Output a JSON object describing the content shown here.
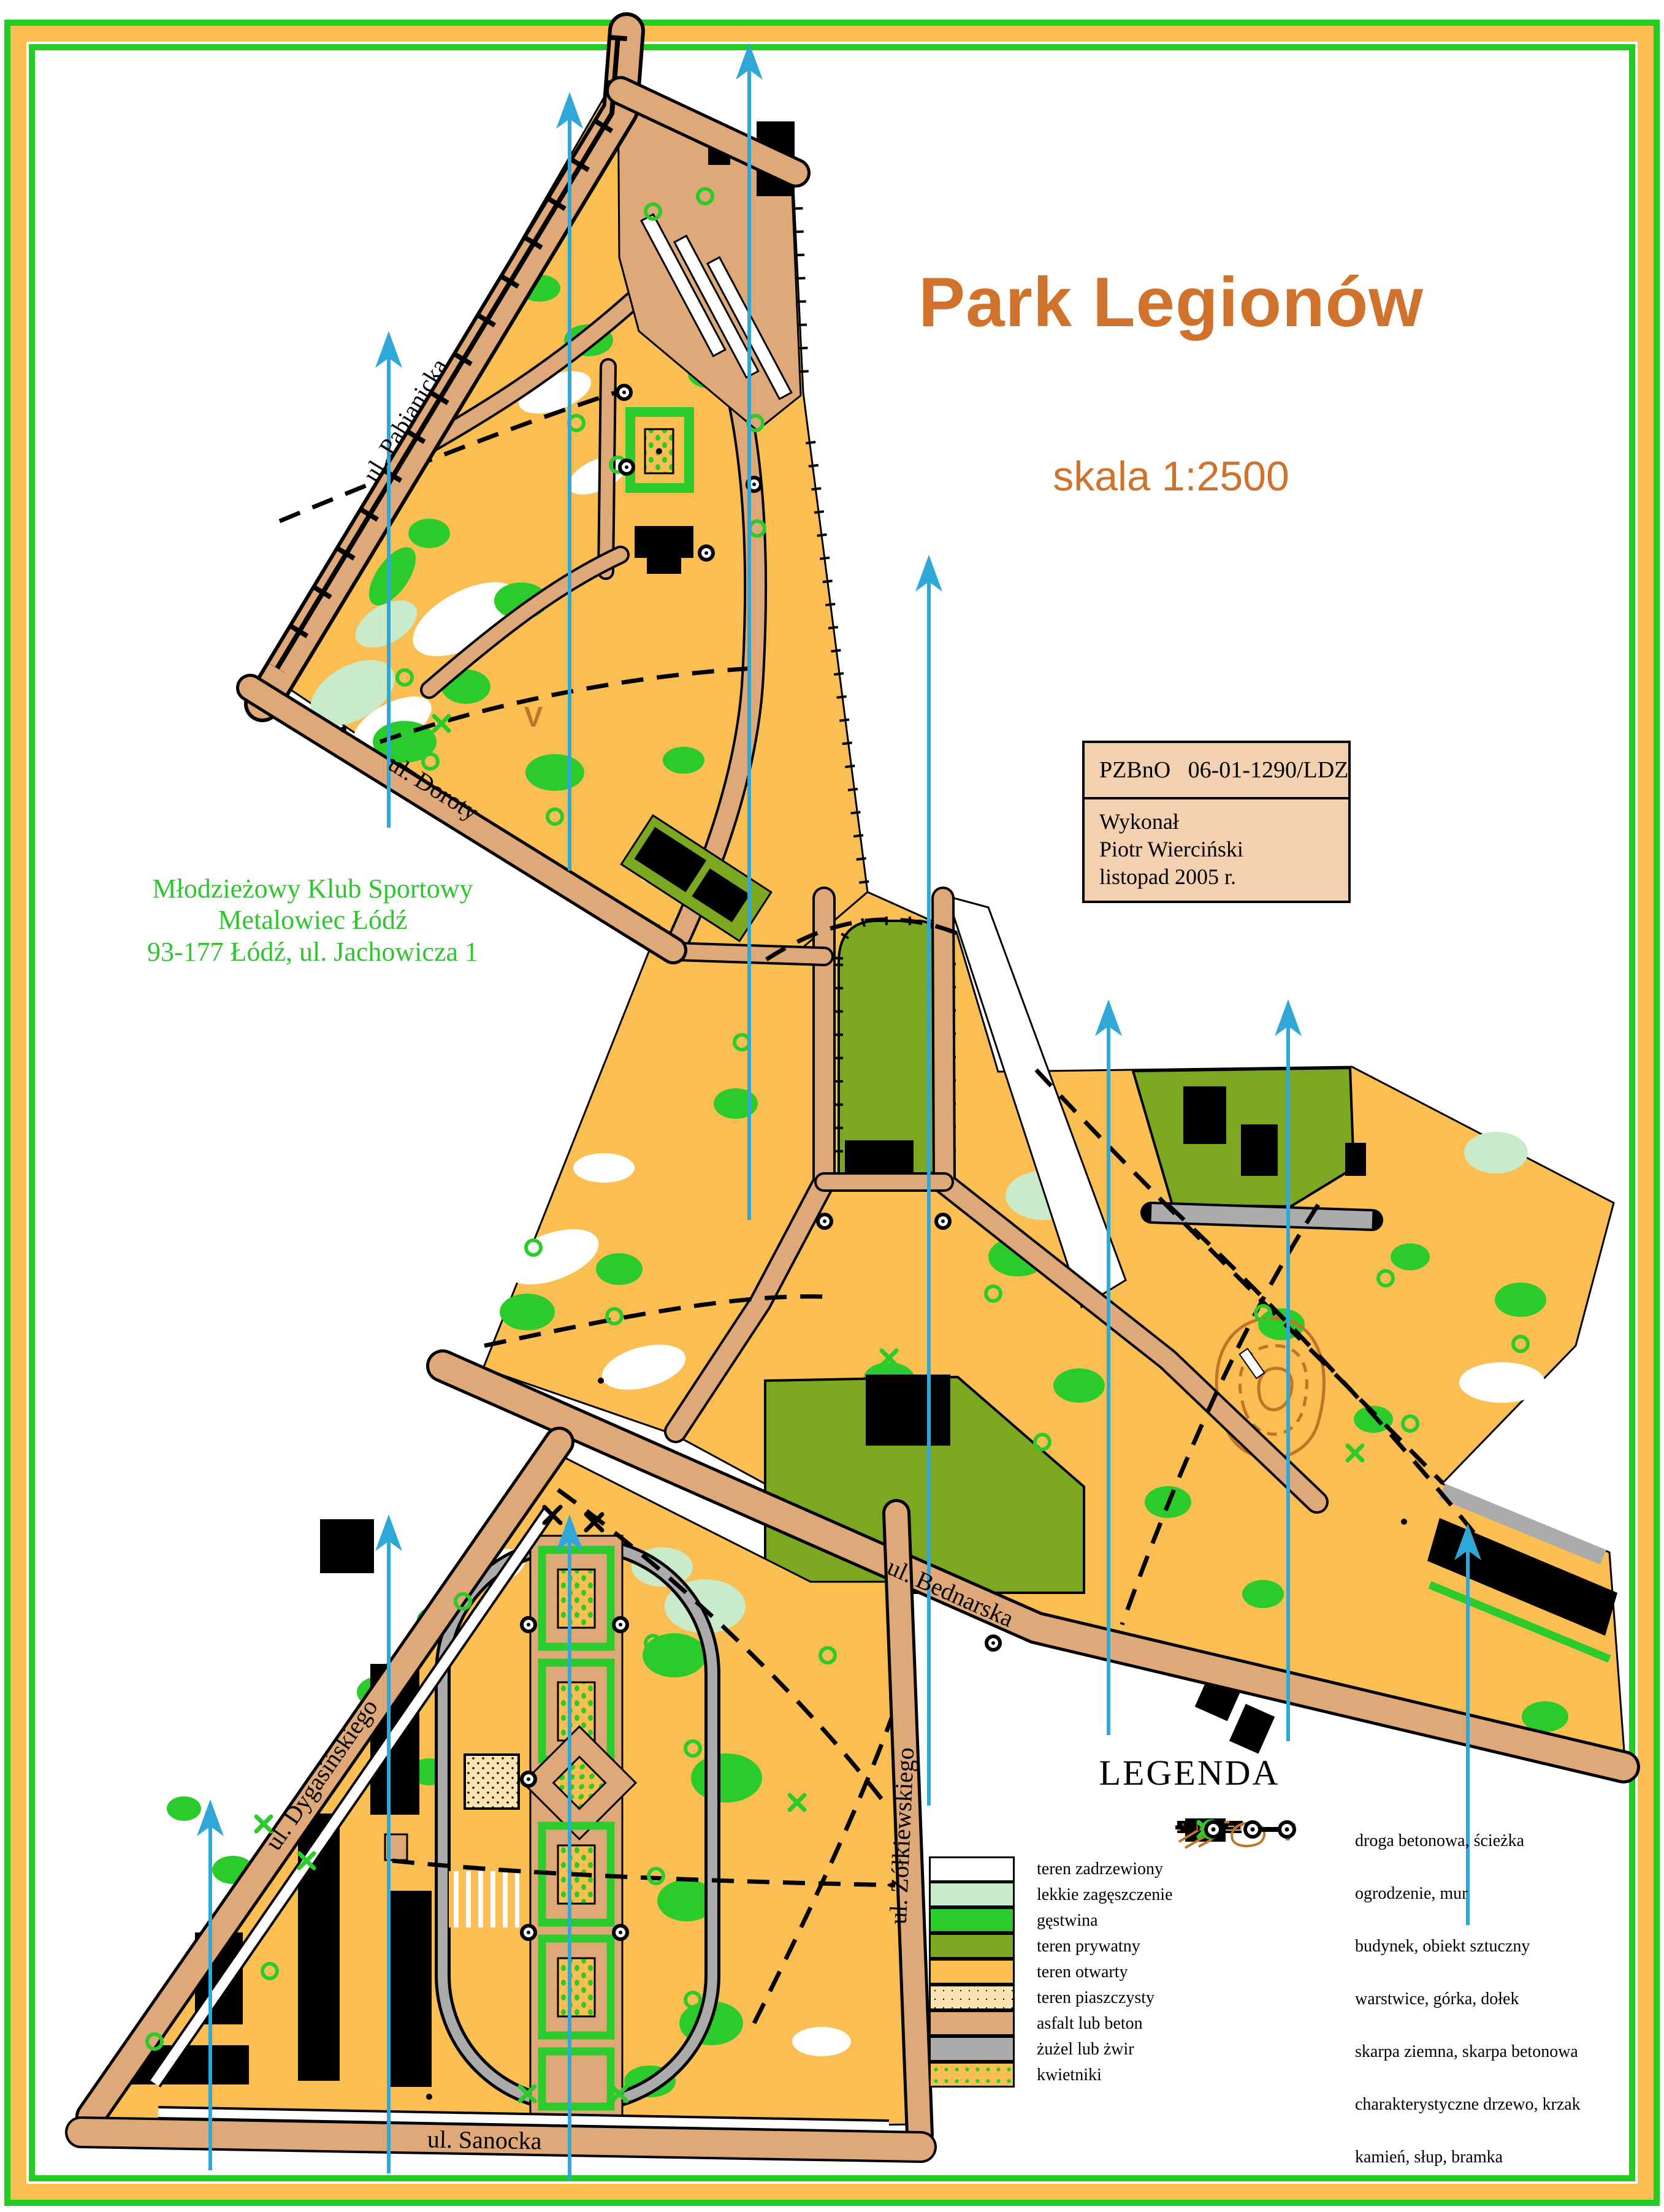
{
  "page": {
    "title": "Park Legionów",
    "scale_label": "skala 1:2500"
  },
  "club": {
    "line1": "Młodzieżowy Klub Sportowy",
    "line2": "Metalowiec Łódź",
    "line3": "93-177 Łódź, ul. Jachowicza 1"
  },
  "info_box": {
    "registry": "PZBnO   06-01-1290/LDZ",
    "made_by_label": "Wykonał",
    "author": "Piotr Wierciński",
    "date": "listopad 2005 r."
  },
  "streets": {
    "pabianicka": "ul. Pabianicka",
    "doroty": "ul. Doroty",
    "bednarska": "ul. Bednarska",
    "dygasinskiego": "ul. Dygasińskiego",
    "zolkiewskiego": "ul. Żółkiewskiego",
    "sanocka": "ul. Sanocka"
  },
  "legend": {
    "title": "LEGENDA",
    "area_items": [
      {
        "label": "teren zadrzewiony",
        "color": "#ffffff"
      },
      {
        "label": "lekkie zagęszczenie",
        "color": "#c9ebc9"
      },
      {
        "label": "gęstwina",
        "color": "#2ccb2c"
      },
      {
        "label": "teren prywatny",
        "color": "#7ca821"
      },
      {
        "label": "teren otwarty",
        "color": "#fbbe52"
      },
      {
        "label": "teren piaszczysty",
        "color": "#fae3b0"
      },
      {
        "label": "asfalt lub beton",
        "color": "#dfa878"
      },
      {
        "label": "żużel lub żwir",
        "color": "#ababab"
      },
      {
        "label": "kwietniki",
        "color": "#fbbe52"
      }
    ],
    "symbol_items": [
      {
        "label": "droga betonowa, ścieżka"
      },
      {
        "label": "ogrodzenie, mur"
      },
      {
        "label": "budynek, obiekt sztuczny"
      },
      {
        "label": "warstwice, górka, dołek"
      },
      {
        "label": "skarpa ziemna, skarpa betonowa"
      },
      {
        "label": "charakterystyczne drzewo, krzak"
      },
      {
        "label": "kamień, słup, bramka"
      }
    ]
  },
  "colors": {
    "frame_green": "#22cc22",
    "frame_orange": "#fbbe52",
    "open_terrain": "#fbbe52",
    "thicket_green": "#2ccb2c",
    "light_green": "#c9ebc9",
    "private_olive": "#7ca821",
    "sand": "#fae3b0",
    "asphalt_tan": "#dfa878",
    "gravel_gray": "#ababab",
    "contour_brown": "#c07428",
    "meridian_blue": "#2fa8d8",
    "title_orange": "#d0722b",
    "club_green": "#2ec52e",
    "infobox_bg": "#f2d0b0"
  }
}
